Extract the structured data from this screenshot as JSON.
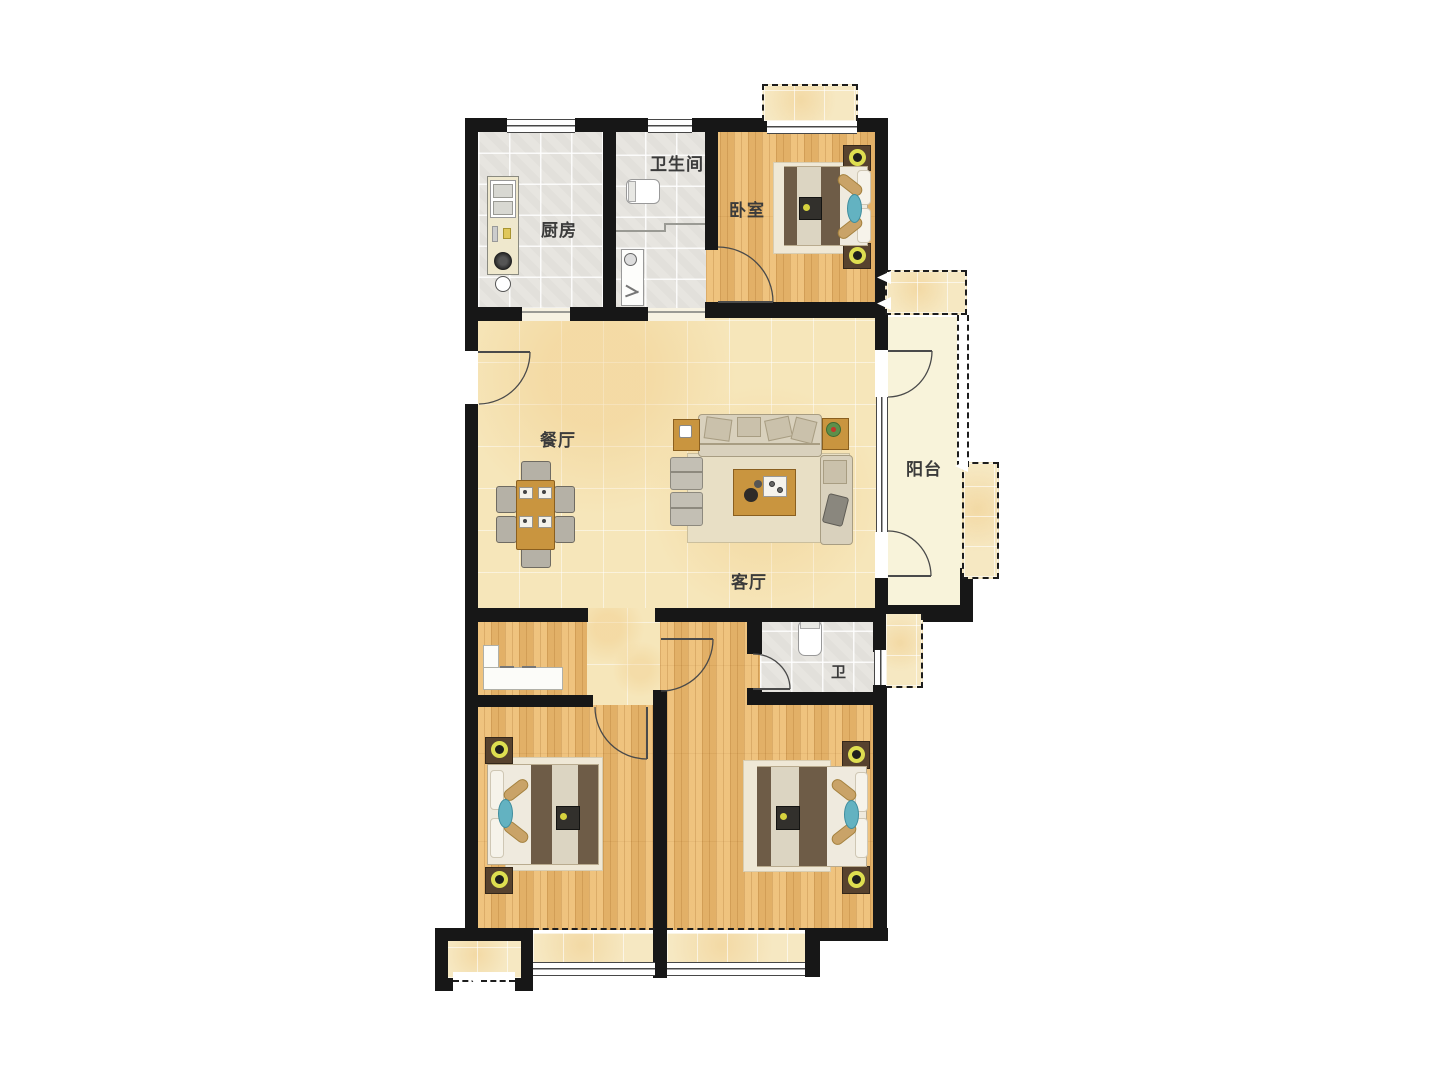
{
  "rooms": {
    "kitchen": {
      "label": "厨房"
    },
    "bathroom": {
      "label": "卫生间"
    },
    "bedroom": {
      "label": "卧室"
    },
    "dining": {
      "label": "餐厅"
    },
    "living": {
      "label": "客厅"
    },
    "balcony": {
      "label": "阳台"
    },
    "toilet": {
      "label": "卫"
    }
  },
  "colors": {
    "wall": "#171717",
    "marble_floor": "#f6e6ba",
    "wood_floor": "#edbc70",
    "gray_tile": "#e7e5e0",
    "bay_tile": "#f6e8c2",
    "balcony_floor": "#f8f3da",
    "blanket_brown": "#6e5c47",
    "runner_cream": "#dcd5c2",
    "accent_teal": "#63b2c1",
    "lamp_yellow": "#dede50",
    "wood_furniture": "#c9953f",
    "sofa_beige": "#d9d1bd"
  }
}
